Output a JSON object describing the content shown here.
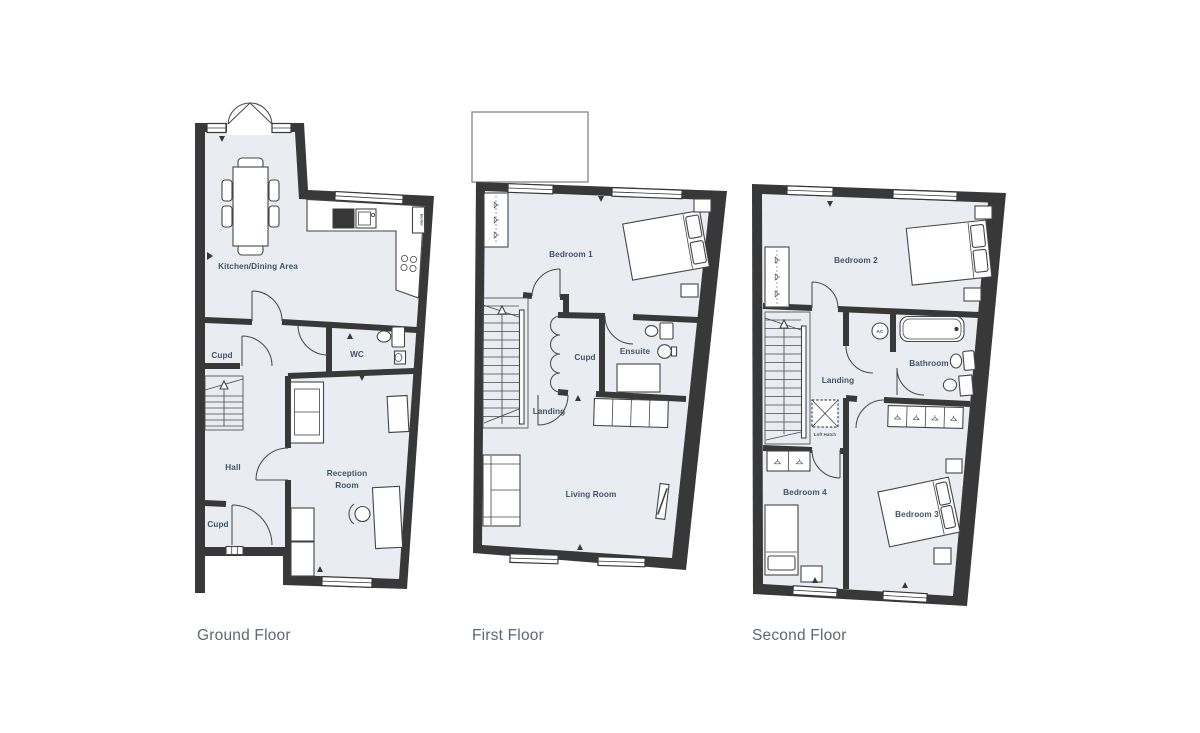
{
  "document": {
    "type": "property-floorplan",
    "background": "#ffffff"
  },
  "colors": {
    "wall": "#383838",
    "floor_fill": "#e9edf1",
    "room_label": "#42526b",
    "floor_title": "#5c6873",
    "furniture_stroke": "#454545",
    "roof_outline": "#8d8d8d"
  },
  "floors": {
    "ground": {
      "title": "Ground Floor",
      "rooms": {
        "kitchen": "Kitchen/Dining Area",
        "cupd_upper": "Cupd",
        "wc": "WC",
        "hall": "Hall",
        "cupd_lower": "Cupd",
        "reception_line1": "Reception",
        "reception_line2": "Room",
        "boiler": "Boiler"
      }
    },
    "first": {
      "title": "First Floor",
      "rooms": {
        "bedroom1": "Bedroom 1",
        "cupd": "Cupd",
        "ensuite": "Ensuite",
        "landing": "Landing",
        "living": "Living Room"
      }
    },
    "second": {
      "title": "Second Floor",
      "rooms": {
        "bedroom2": "Bedroom 2",
        "ac": "AC",
        "bathroom": "Bathroom",
        "landing": "Landing",
        "loft_hatch": "Loft Hatch",
        "bedroom4": "Bedroom 4",
        "bedroom3": "Bedroom 3"
      }
    }
  }
}
